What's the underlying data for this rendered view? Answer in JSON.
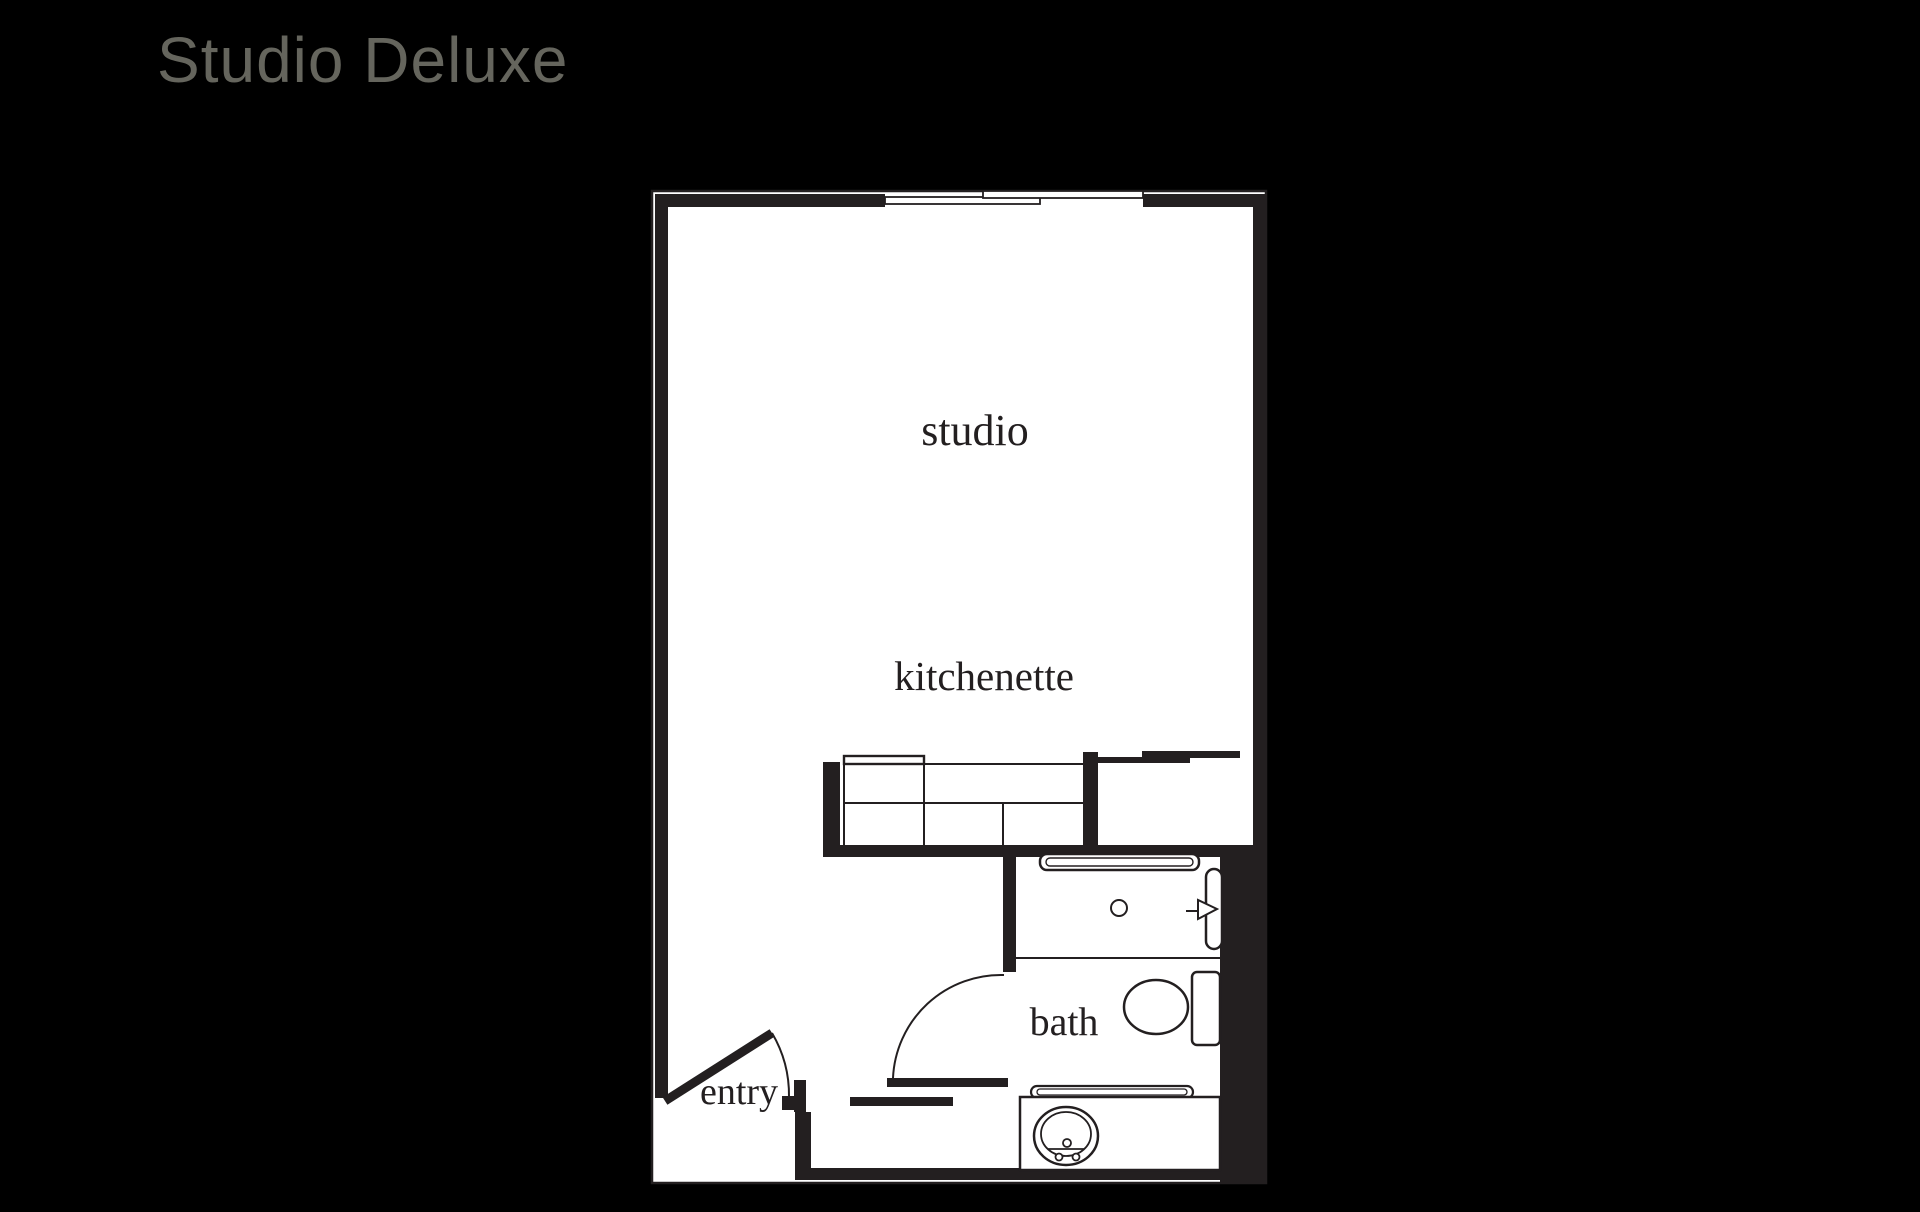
{
  "title": "Studio Deluxe",
  "floor_plan": {
    "room_labels": {
      "studio": "studio",
      "kitchenette": "kitchenette",
      "bath": "bath",
      "entry": "entry"
    }
  },
  "colors": {
    "background": "#000000",
    "floor": "#ffffff",
    "wall": "#231f20",
    "title_text": "#65655d",
    "label_text": "#231f20"
  }
}
